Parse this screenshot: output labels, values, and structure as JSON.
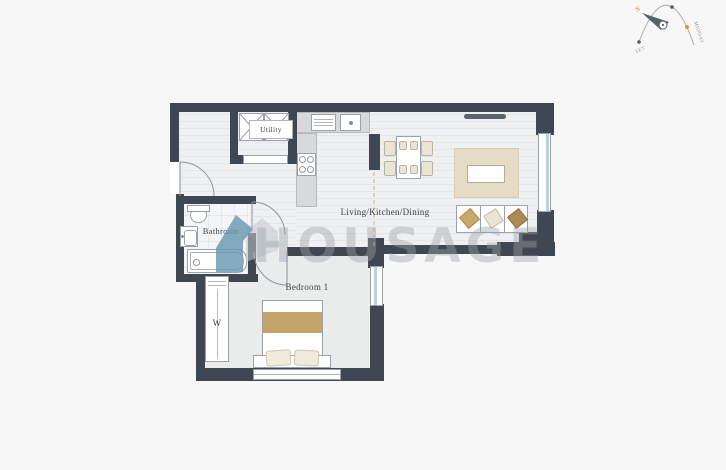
{
  "colors": {
    "page": "#f7f7f7",
    "wall": "#3f4852",
    "floor_light": "#eef0f1",
    "floor_stripe": "#e4e6e8",
    "bedroom_floor": "#eaeceb",
    "counter": "#d7d9db",
    "window_glass": "#b9d3e2",
    "rug": "#e5dcc5",
    "tan": "#c4a569",
    "cream": "#eae4d4",
    "sofa_gold": "#c9a96b",
    "sofa_brown": "#ad8a55",
    "tv_dark": "#5b6570",
    "label": "#3a4046",
    "watermark_gray": "#9ba2a8",
    "watermark_blue": "#6a98b0",
    "compass_gold": "#c9a227"
  },
  "rooms": {
    "living": {
      "label": "Living/Kitchen/Dining"
    },
    "bedroom": {
      "label": "Bedroom 1"
    },
    "bathroom": {
      "label": "Bathroom"
    },
    "utility": {
      "label": "Utility"
    },
    "wardrobe": {
      "label": "W"
    }
  },
  "watermark": {
    "text": "HOUSAGE"
  },
  "compass": {
    "north": "N",
    "sunset": "SET",
    "midday": "MIDDAY"
  }
}
